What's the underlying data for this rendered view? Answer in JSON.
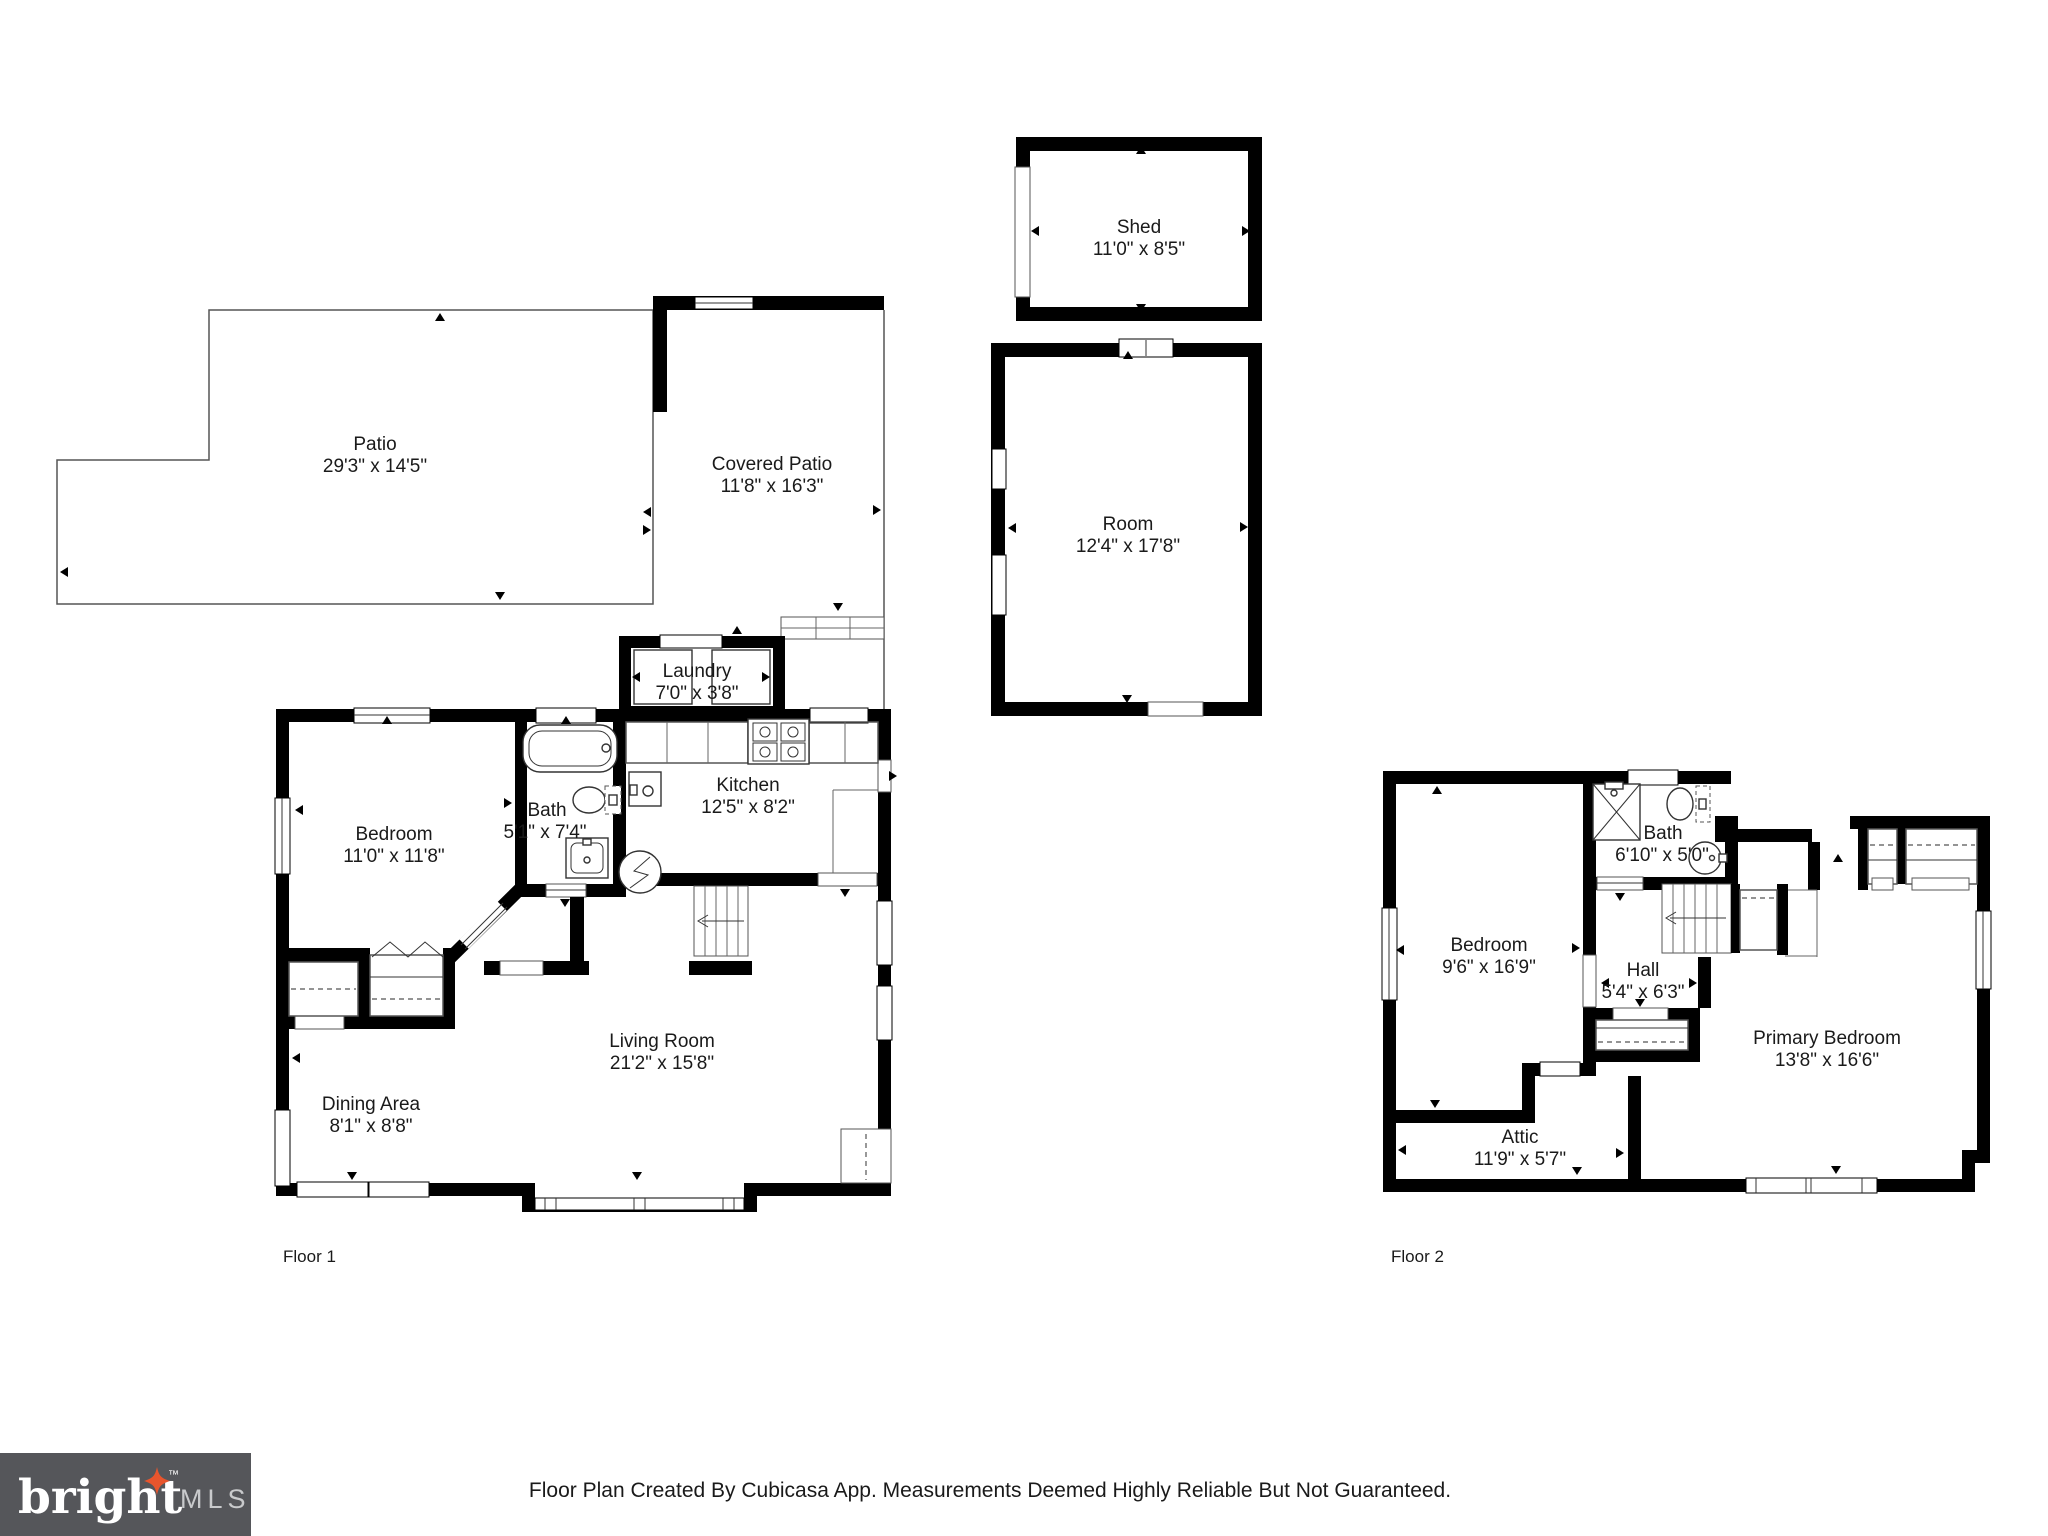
{
  "disclaimer": "Floor Plan Created By Cubicasa App. Measurements Deemed Highly Reliable But Not Guaranteed.",
  "logo": {
    "brand": "bright",
    "tm": "™",
    "suffix": "MLS"
  },
  "floor_labels": {
    "floor1": "Floor 1",
    "floor2": "Floor 2"
  },
  "colors": {
    "wall": "#000000",
    "logo_bg": "#55565a",
    "accent_star": "#e8552d",
    "text": "#1a1a1a"
  },
  "rooms": {
    "shed": {
      "name": "Shed",
      "dims": "11'0\" x 8'5\""
    },
    "room": {
      "name": "Room",
      "dims": "12'4\" x 17'8\""
    },
    "patio": {
      "name": "Patio",
      "dims": "29'3\" x 14'5\""
    },
    "covered_patio": {
      "name": "Covered Patio",
      "dims": "11'8\" x 16'3\""
    },
    "laundry": {
      "name": "Laundry",
      "dims": "7'0\" x 3'8\""
    },
    "bedroom_f1": {
      "name": "Bedroom",
      "dims": "11'0\" x 11'8\""
    },
    "bath_f1": {
      "name": "Bath",
      "dims": "5'1\" x 7'4\""
    },
    "kitchen": {
      "name": "Kitchen",
      "dims": "12'5\" x 8'2\""
    },
    "living_room": {
      "name": "Living Room",
      "dims": "21'2\" x 15'8\""
    },
    "dining_area": {
      "name": "Dining Area",
      "dims": "8'1\" x 8'8\""
    },
    "bedroom_f2": {
      "name": "Bedroom",
      "dims": "9'6\" x 16'9\""
    },
    "bath_f2": {
      "name": "Bath",
      "dims": "6'10\" x 5'0\""
    },
    "hall": {
      "name": "Hall",
      "dims": "5'4\" x 6'3\""
    },
    "primary_bedroom": {
      "name": "Primary Bedroom",
      "dims": "13'8\" x 16'6\""
    },
    "attic": {
      "name": "Attic",
      "dims": "11'9\" x 5'7\""
    }
  }
}
